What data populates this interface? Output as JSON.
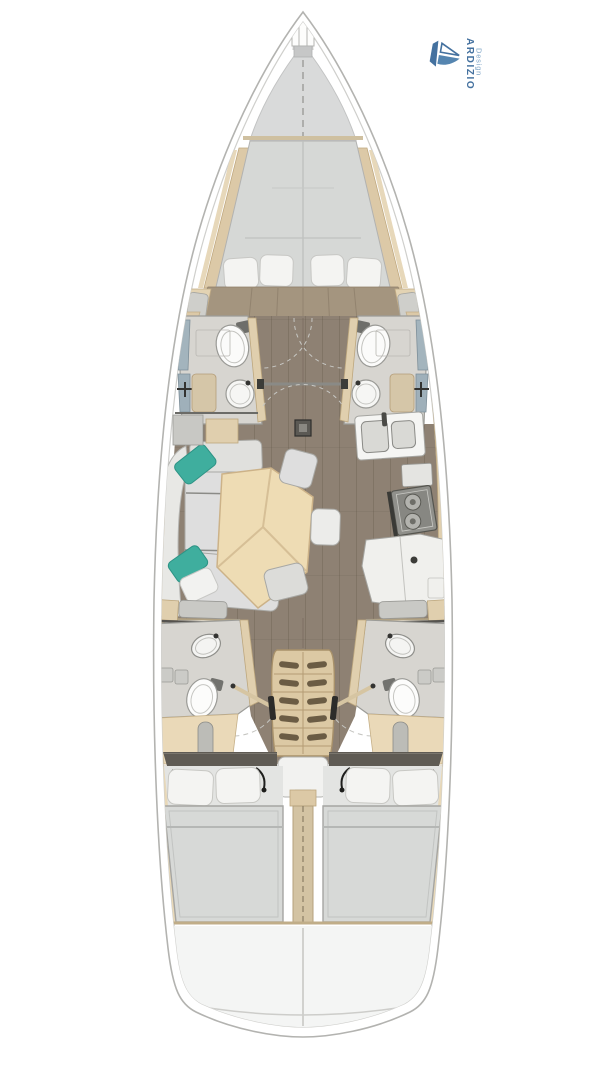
{
  "branding": {
    "name": "ARDIZIO",
    "subtitle": "Design",
    "color": "#44719f",
    "subtitle_color": "#7ea4c6",
    "icon": "sailboat-logo-icon"
  },
  "layout": {
    "type": "sailing-yacht-interior-floor-plan",
    "orientation": "bow-up",
    "rooms": [
      {
        "id": "anchor-locker"
      },
      {
        "id": "foredeck"
      },
      {
        "id": "forward-cabin",
        "features": [
          "v-berth",
          "4-pillows",
          "side-benches"
        ]
      },
      {
        "id": "forward-head-port",
        "features": [
          "toilet",
          "round-sink",
          "shower"
        ]
      },
      {
        "id": "forward-head-starboard",
        "features": [
          "toilet",
          "round-sink",
          "shower"
        ]
      },
      {
        "id": "saloon",
        "features": [
          "l-shaped-sofa",
          "teal-cushions",
          "pentagonal-table",
          "3-chairs",
          "mast-post"
        ]
      },
      {
        "id": "galley",
        "features": [
          "double-sink",
          "2-burner-stove",
          "l-counter"
        ]
      },
      {
        "id": "aft-head-port",
        "features": [
          "toilet",
          "round-sink",
          "shower",
          "door-swing"
        ]
      },
      {
        "id": "aft-head-starboard",
        "features": [
          "toilet",
          "round-sink",
          "shower",
          "door-swing"
        ]
      },
      {
        "id": "companionway",
        "features": [
          "5-step-ladder",
          "handrails",
          "engine-box"
        ]
      },
      {
        "id": "aft-cabin-port",
        "features": [
          "double-berth",
          "2-pillows"
        ]
      },
      {
        "id": "aft-cabin-starboard",
        "features": [
          "double-berth",
          "2-pillows"
        ]
      },
      {
        "id": "stern-transom"
      }
    ]
  },
  "palette": {
    "paper": "#ffffff",
    "hull_line": "#b3b3b0",
    "deck": "#d9dada",
    "bulkhead_tan": "#cfc0a0",
    "berth": "#d6d8d6",
    "pillow": "#f4f4f2",
    "wood_floor": "#8e8173",
    "cabin_floor": "#a4957f",
    "trim": "#dcc9a7",
    "sofa": "#e0e0dd",
    "teal": "#3fae9e",
    "table": "#eedcb4",
    "bath_floor": "#d7d5d0",
    "shower": "#a3b4bd",
    "fixture": "#fbfbfa",
    "stove": "#90908b",
    "stairs": "#dcc9a4",
    "mattress": "#d7d9d7",
    "headboard": "#5f5b54",
    "divider": "#d3c3a3",
    "stern": "#f4f5f4"
  }
}
